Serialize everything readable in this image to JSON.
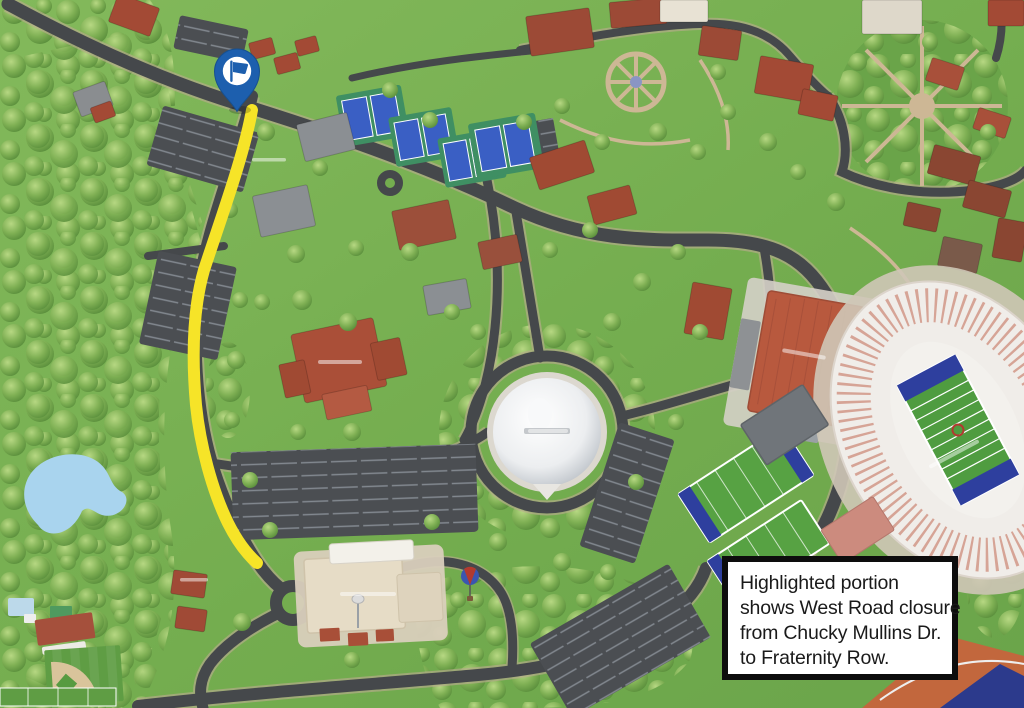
{
  "map": {
    "name": "illustrated-campus-map",
    "colors": {
      "grass": "#74ad4f",
      "forest_tree": "#6fa348",
      "road": "#45484b",
      "road_casing": "#b9ab8e",
      "water": "#a9d4ee",
      "parking": "#4b4e52",
      "walkway": "#cdb795",
      "building_roof_red": "#a34a35",
      "stadium_field_green": "#4f9c40",
      "endzone_blue": "#2e3f9e",
      "tennis_court_blue": "#3a5fc4"
    }
  },
  "highlight": {
    "label": "road-closure-highlight",
    "color": "#f6e428"
  },
  "marker": {
    "label": "flag-pin",
    "pin_color": "#1d5fae",
    "icon": "flag-icon",
    "icon_color": "#1d5fae",
    "circle_color": "#ffffff"
  },
  "annotation": {
    "text": "Highlighted portion shows West Road closure from Chucky Mullins Dr. to Fraternity Row.",
    "lines": [
      "Highlighted portion",
      "shows West Road closure",
      "from Chucky Mullins Dr.",
      "to Fraternity Row."
    ],
    "border_color": "#0d0d0d",
    "background_color": "#ffffff",
    "text_color": "#1a1a1a"
  }
}
